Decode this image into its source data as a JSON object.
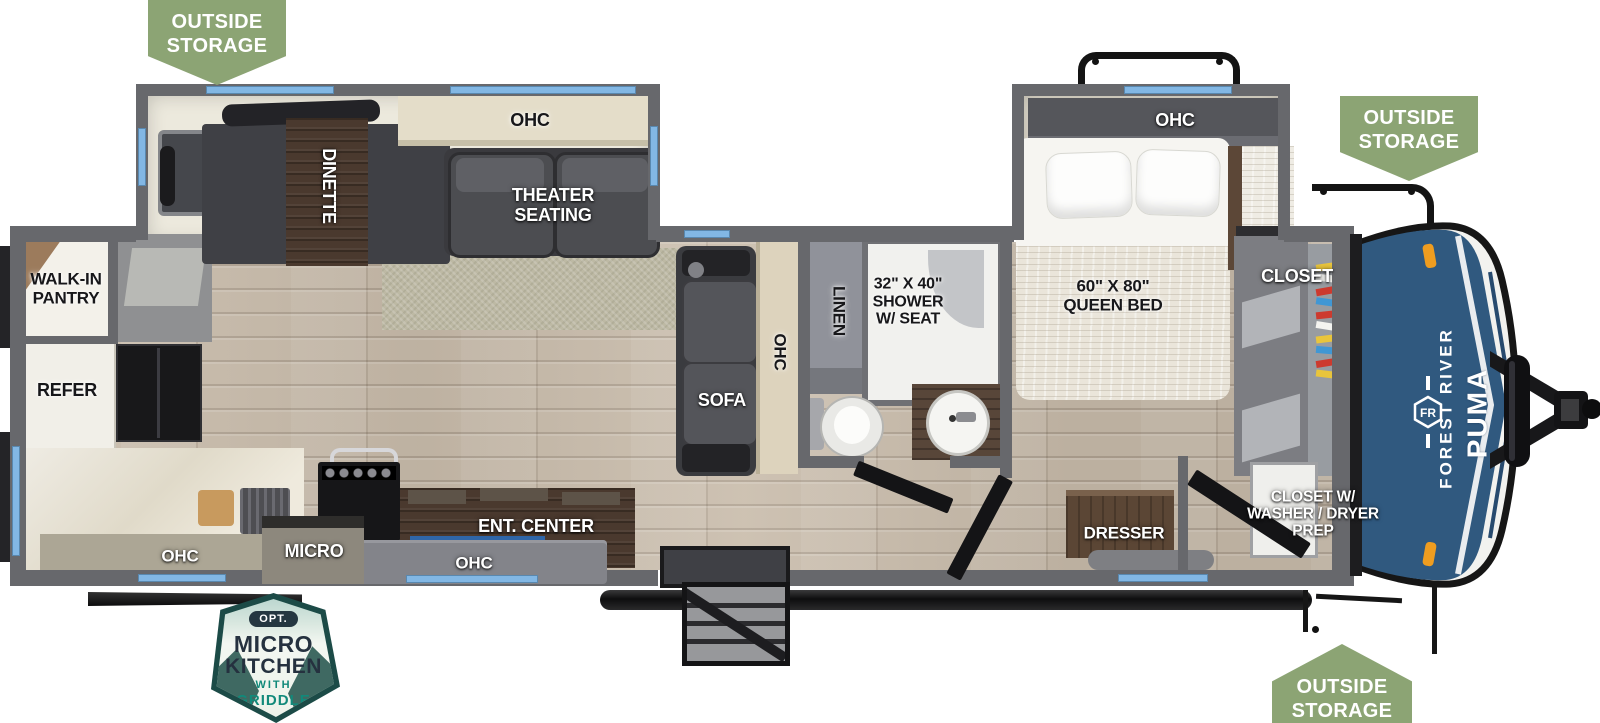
{
  "callouts": {
    "outside_storage": {
      "line1": "OUTSIDE",
      "line2": "STORAGE"
    }
  },
  "option_badge": {
    "tag": "OPT.",
    "line1": "MICRO",
    "line2": "KITCHEN",
    "line3": "WITH",
    "line4": "GRIDDLE"
  },
  "brand": {
    "logo": "FR",
    "maker": "FOREST RIVER",
    "model": "PUMA"
  },
  "rooms": {
    "living_slide": {
      "dinette": "DINETTE",
      "ohc": "OHC",
      "theater_line1": "THEATER",
      "theater_line2": "SEATING"
    },
    "kitchen": {
      "pantry_line1": "WALK-IN",
      "pantry_line2": "PANTRY",
      "refer": "REFER",
      "ohc": "OHC",
      "micro": "MICRO",
      "ent_center": "ENT. CENTER",
      "ent_ohc": "OHC"
    },
    "living": {
      "sofa": "SOFA",
      "ohc": "OHC"
    },
    "bath": {
      "linen": "LINEN",
      "shower_line1": "32\" X 40\"",
      "shower_line2": "SHOWER",
      "shower_line3": "W/ SEAT"
    },
    "bedroom": {
      "ohc": "OHC",
      "bed_line1": "60\" X 80\"",
      "bed_line2": "QUEEN BED",
      "closet": "CLOSET",
      "dresser": "DRESSER",
      "wd_line1": "CLOSET W/",
      "wd_line2": "WASHER / DRYER",
      "wd_line3": "PREP"
    }
  },
  "colors": {
    "banner_green": "#8CA474",
    "wall_gray": "#67686C",
    "window_blue": "#82B7E4",
    "front_cap_blue": "#30597F",
    "badge_teal": "#1C4B47",
    "badge_accent": "#11897A"
  }
}
